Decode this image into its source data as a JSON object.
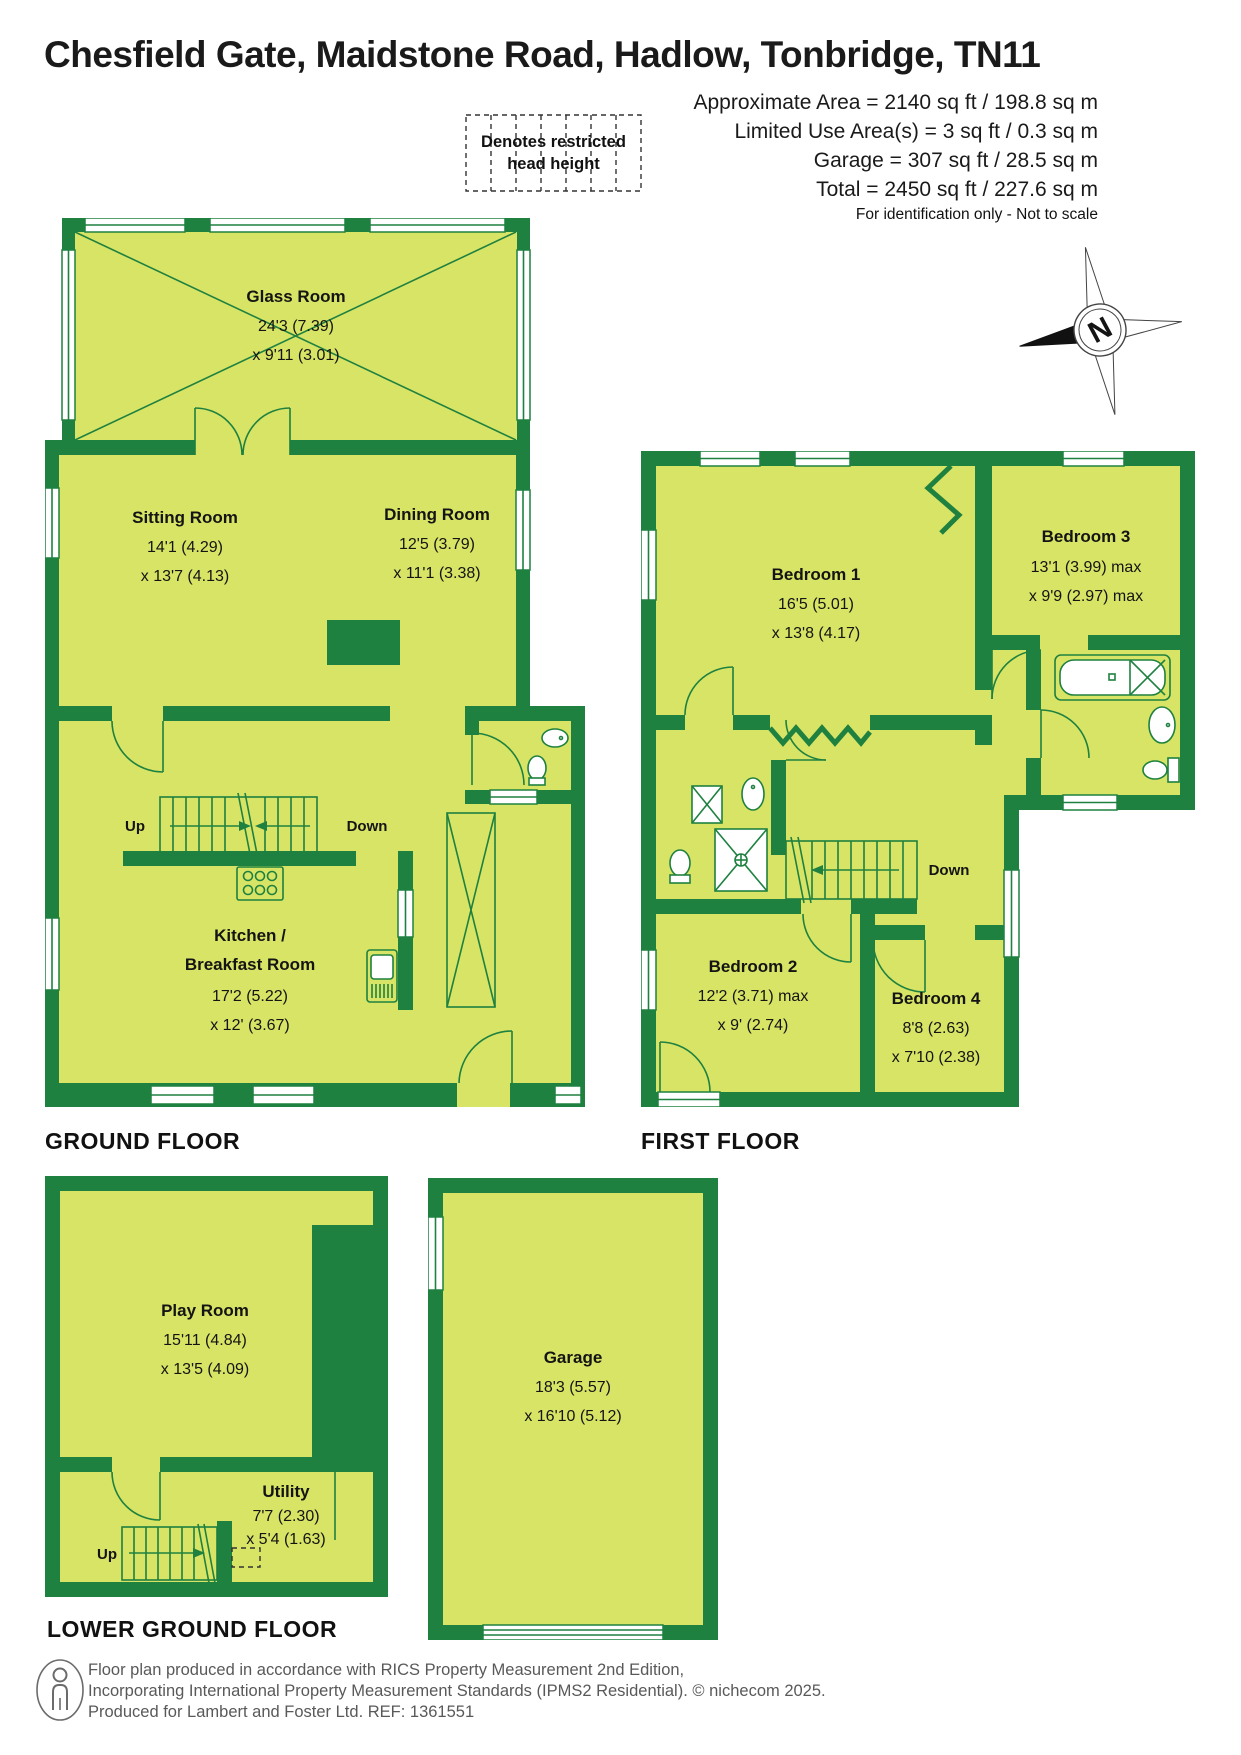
{
  "title": "Chesfield Gate, Maidstone Road, Hadlow, Tonbridge, TN11",
  "summary": {
    "line1": "Approximate Area = 2140 sq ft / 198.8 sq m",
    "line2": "Limited Use Area(s) = 3 sq ft / 0.3 sq m",
    "line3": "Garage = 307 sq ft / 28.5 sq m",
    "line4": "Total = 2450 sq ft / 227.6 sq m",
    "disclaimer": "For identification only - Not to scale"
  },
  "legend": {
    "line1": "Denotes restricted",
    "line2": "head height"
  },
  "compass": {
    "letter": "N"
  },
  "ground": {
    "label": "GROUND FLOOR",
    "glass_room": {
      "name": "Glass Room",
      "d1": "24'3 (7.39)",
      "d2": "x 9'11 (3.01)"
    },
    "sitting_room": {
      "name": "Sitting Room",
      "d1": "14'1 (4.29)",
      "d2": "x 13'7 (4.13)"
    },
    "dining_room": {
      "name": "Dining Room",
      "d1": "12'5 (3.79)",
      "d2": "x 11'1 (3.38)"
    },
    "kitchen": {
      "name": "Kitchen /",
      "name2": "Breakfast Room",
      "d1": "17'2 (5.22)",
      "d2": "x 12' (3.67)"
    },
    "up": "Up",
    "down": "Down"
  },
  "first": {
    "label": "FIRST FLOOR",
    "bedroom1": {
      "name": "Bedroom 1",
      "d1": "16'5 (5.01)",
      "d2": "x 13'8 (4.17)"
    },
    "bedroom2": {
      "name": "Bedroom 2",
      "d1": "12'2 (3.71) max",
      "d2": "x 9' (2.74)"
    },
    "bedroom3": {
      "name": "Bedroom 3",
      "d1": "13'1 (3.99) max",
      "d2": "x 9'9 (2.97) max"
    },
    "bedroom4": {
      "name": "Bedroom 4",
      "d1": "8'8 (2.63)",
      "d2": "x 7'10 (2.38)"
    },
    "down": "Down"
  },
  "lower": {
    "label": "LOWER GROUND FLOOR",
    "play_room": {
      "name": "Play Room",
      "d1": "15'11 (4.84)",
      "d2": "x 13'5 (4.09)"
    },
    "utility": {
      "name": "Utility",
      "d1": "7'7 (2.30)",
      "d2": "x 5'4 (1.63)"
    },
    "garage": {
      "name": "Garage",
      "d1": "18'3 (5.57)",
      "d2": "x 16'10 (5.12)"
    },
    "up": "Up"
  },
  "footer": {
    "line1": "Floor plan produced in accordance with RICS Property Measurement 2nd Edition,",
    "line2": "Incorporating International Property Measurement Standards (IPMS2 Residential).   © nichecom 2025.",
    "line3": "Produced for Lambert and Foster Ltd.   REF:  1361551"
  },
  "colors": {
    "wall_green": "#1f8140",
    "floor_green": "#d8e465",
    "text_black": "#1a1a1a",
    "footer_gray": "#595959"
  }
}
